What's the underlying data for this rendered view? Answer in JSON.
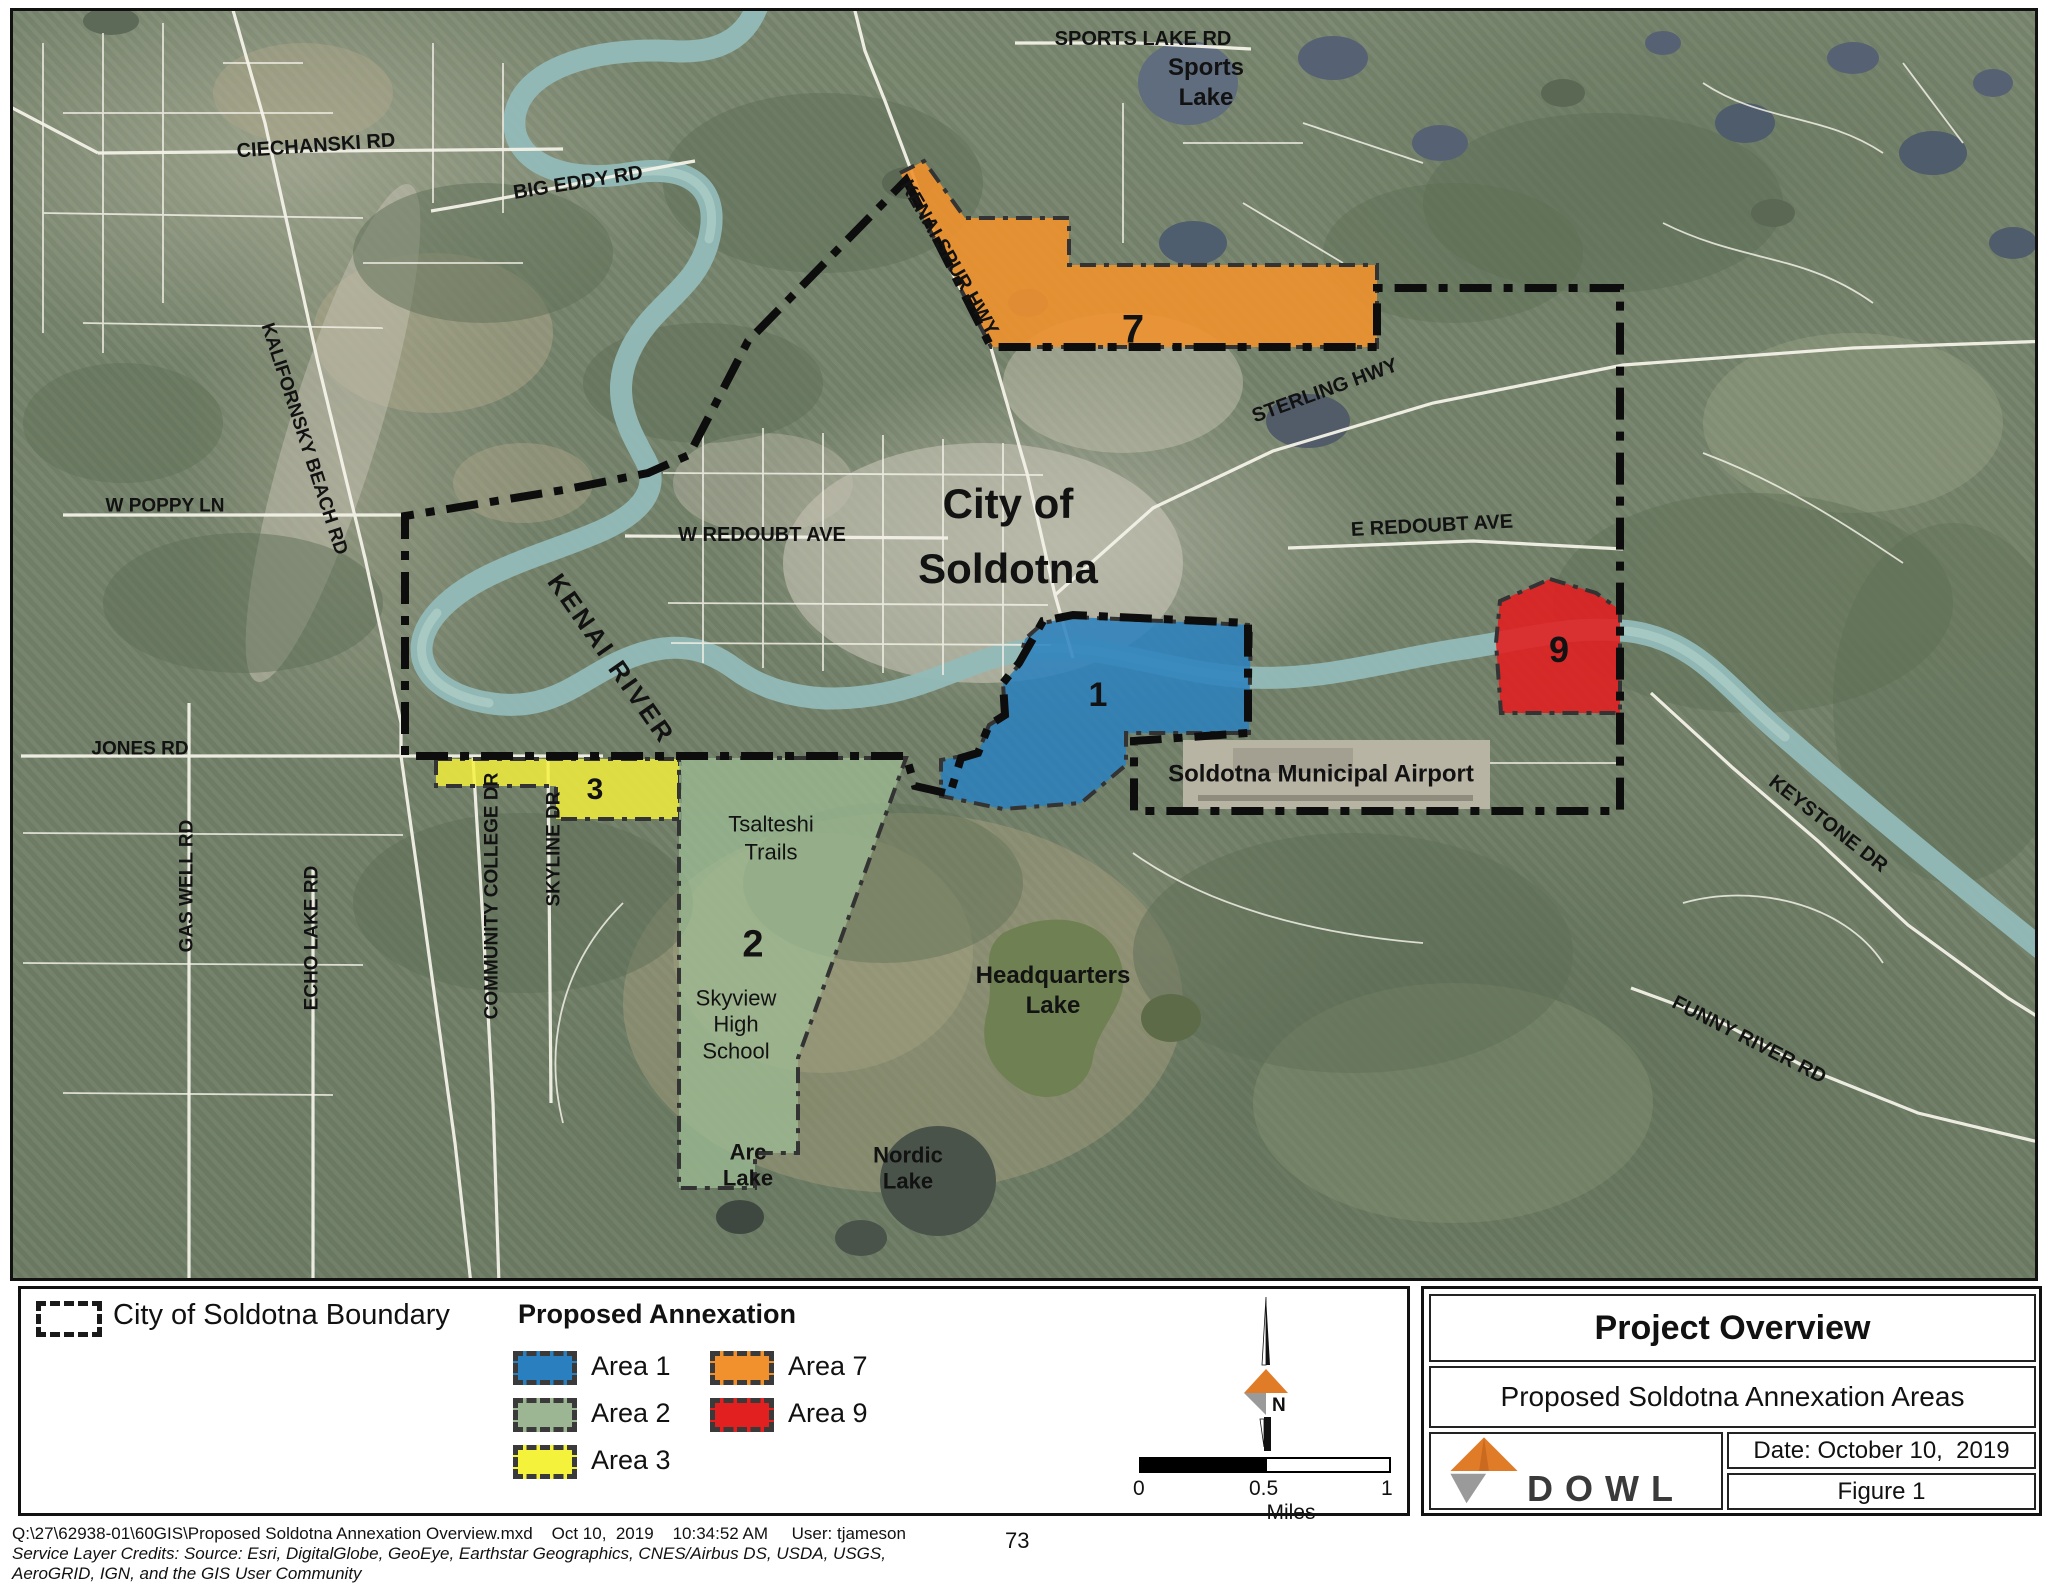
{
  "map": {
    "labels": [
      {
        "id": "sports-lake-rd",
        "t": "SPORTS LAKE RD",
        "x": 1140,
        "y": 36,
        "r": 0,
        "s": 20
      },
      {
        "id": "sports-lake",
        "t": "Sports\nLake",
        "x": 1203,
        "y": 80,
        "r": 0,
        "s": 24,
        "lh": 1.25
      },
      {
        "id": "ciechanski-rd",
        "t": "CIECHANSKI RD",
        "x": 313,
        "y": 143,
        "r": -4,
        "s": 20
      },
      {
        "id": "big-eddy-rd",
        "t": "BIG EDDY RD",
        "x": 575,
        "y": 180,
        "r": -9,
        "s": 20
      },
      {
        "id": "kenai-spur-hwy",
        "t": "KENAI SPUR HWY",
        "x": 946,
        "y": 255,
        "r": 60,
        "s": 20
      },
      {
        "id": "sterling-hwy",
        "t": "STERLING HWY",
        "x": 1322,
        "y": 388,
        "r": -20,
        "s": 20
      },
      {
        "id": "city-of-soldotna",
        "t": "City of\nSoldotna",
        "x": 1005,
        "y": 533,
        "r": 0,
        "s": 42,
        "lh": 1.55
      },
      {
        "id": "w-redoubt-ave",
        "t": "W REDOUBT AVE",
        "x": 759,
        "y": 532,
        "r": 0,
        "s": 20
      },
      {
        "id": "e-redoubt-ave",
        "t": "E REDOUBT AVE",
        "x": 1429,
        "y": 523,
        "r": -3,
        "s": 20
      },
      {
        "id": "kenai-river",
        "t": "KENAI RIVER",
        "x": 608,
        "y": 656,
        "r": 55,
        "s": 26,
        "ls": 3
      },
      {
        "id": "soldotna-municipal-airport",
        "t": "Soldotna Municipal Airport",
        "x": 1318,
        "y": 772,
        "r": 0,
        "s": 24
      },
      {
        "id": "jones-rd",
        "t": "JONES RD",
        "x": 137,
        "y": 746,
        "r": 0,
        "s": 19
      },
      {
        "id": "w-poppy-ln",
        "t": "W POPPY LN",
        "x": 162,
        "y": 503,
        "r": 0,
        "s": 19
      },
      {
        "id": "kalifornsky-beach-rd",
        "t": "KALIFORNSKY BEACH RD",
        "x": 301,
        "y": 436,
        "r": 72,
        "s": 19
      },
      {
        "id": "gas-well-rd",
        "t": "GAS WELL RD",
        "x": 184,
        "y": 883,
        "r": -90,
        "s": 19
      },
      {
        "id": "echo-lake-rd",
        "t": "ECHO LAKE RD",
        "x": 309,
        "y": 935,
        "r": -90,
        "s": 19
      },
      {
        "id": "community-college-dr",
        "t": "COMMUNITY COLLEGE DR",
        "x": 489,
        "y": 893,
        "r": -90,
        "s": 19
      },
      {
        "id": "skyline-dr",
        "t": "SKYLINE DR",
        "x": 551,
        "y": 846,
        "r": -90,
        "s": 19
      },
      {
        "id": "tsalteshi-trails",
        "t": "Tsalteshi\nTrails",
        "x": 768,
        "y": 835,
        "r": 0,
        "s": 22,
        "w": 400,
        "lh": 1.25
      },
      {
        "id": "area-2-number",
        "t": "2",
        "x": 750,
        "y": 942,
        "r": 0,
        "s": 38
      },
      {
        "id": "skyview-high-school",
        "t": "Skyview\nHigh\nSchool",
        "x": 733,
        "y": 1022,
        "r": 0,
        "s": 22,
        "w": 400,
        "lh": 1.2
      },
      {
        "id": "arc-lake",
        "t": "Arc\nLake",
        "x": 745,
        "y": 1163,
        "r": 0,
        "s": 22,
        "lh": 1.2
      },
      {
        "id": "nordic-lake",
        "t": "Nordic\nLake",
        "x": 905,
        "y": 1166,
        "r": 0,
        "s": 22,
        "lh": 1.2
      },
      {
        "id": "headquarters-lake",
        "t": "Headquarters\nLake",
        "x": 1050,
        "y": 988,
        "r": 0,
        "s": 24,
        "lh": 1.25
      },
      {
        "id": "keystone-dr",
        "t": "KEYSTONE DR",
        "x": 1825,
        "y": 821,
        "r": 38,
        "s": 20
      },
      {
        "id": "funny-river-rd",
        "t": "FUNNY RIVER RD",
        "x": 1746,
        "y": 1037,
        "r": 27,
        "s": 20
      },
      {
        "id": "area-1-number",
        "t": "1",
        "x": 1095,
        "y": 692,
        "r": 0,
        "s": 34
      },
      {
        "id": "area-3-number",
        "t": "3",
        "x": 592,
        "y": 787,
        "r": 0,
        "s": 30
      },
      {
        "id": "area-7-number",
        "t": "7",
        "x": 1130,
        "y": 327,
        "r": 0,
        "s": 40
      },
      {
        "id": "area-9-number",
        "t": "9",
        "x": 1556,
        "y": 647,
        "r": 0,
        "s": 36
      }
    ]
  },
  "legend": {
    "boundary_label": "City of Soldotna Boundary",
    "annexation_title": "Proposed Annexation",
    "areas": [
      {
        "label": "Area 1",
        "color": "#2A7FBE"
      },
      {
        "label": "Area 2",
        "color": "#9CB694"
      },
      {
        "label": "Area 3",
        "color": "#F5F23B"
      },
      {
        "label": "Area 7",
        "color": "#F0912D"
      },
      {
        "label": "Area 9",
        "color": "#E2201F"
      }
    ]
  },
  "north": {
    "label": "N"
  },
  "scale": {
    "zero": "0",
    "half": "0.5",
    "one": "1",
    "unit": "Miles"
  },
  "title_block": {
    "title": "Project Overview",
    "subtitle": "Proposed Soldotna Annexation Areas",
    "date": "Date: October 10,  2019",
    "figure": "Figure 1",
    "logo_text": "DOWL"
  },
  "footer": {
    "line1": "Q:\\27\\62938-01\\60GIS\\Proposed Soldotna Annexation Overview.mxd    Oct 10,  2019    10:34:52 AM     User: tjameson",
    "page_number": "73",
    "credits1": "Service Layer Credits: Source: Esri, DigitalGlobe, GeoEye, Earthstar Geographics, CNES/Airbus DS, USDA, USGS,",
    "credits2": "AeroGRID, IGN, and the GIS User Community"
  },
  "colors": {
    "area1_fill": "rgba(41,128,190,0.85)",
    "area2_fill": "rgba(158,188,148,0.75)",
    "area3_fill": "rgba(245,242,59,0.82)",
    "area7_fill": "rgba(240,145,45,0.9)",
    "area9_fill": "rgba(226,30,32,0.88)",
    "river": "#92bab8",
    "road": "#f2f0e6",
    "boundary": "#0d0d0d"
  }
}
